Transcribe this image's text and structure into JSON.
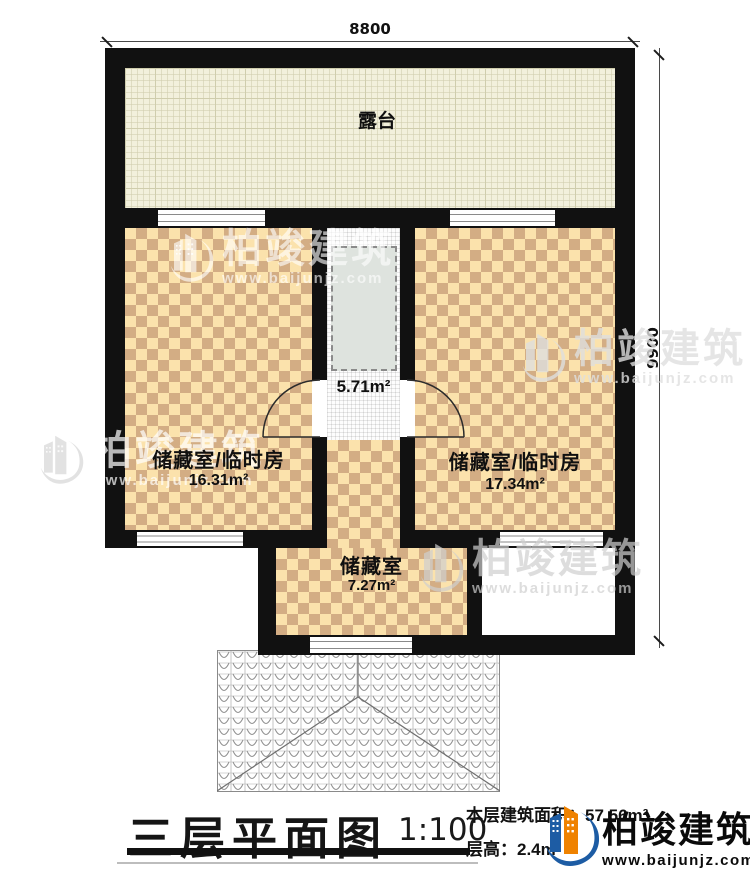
{
  "plan": {
    "dim_width": "8800",
    "dim_height": "9900",
    "rooms": {
      "terrace": {
        "name": "露台"
      },
      "left_storage": {
        "name": "储藏室/临时房",
        "area": "16.31m²"
      },
      "right_storage": {
        "name": "储藏室/临时房",
        "area": "17.34m²"
      },
      "stairwell": {
        "area": "5.71m²"
      },
      "bottom_storage": {
        "name": "储藏室",
        "area": "7.27m²"
      }
    }
  },
  "title_block": {
    "title": "三层平面图",
    "scale": "1:100",
    "area_line": "本层建筑面积：57.56m²",
    "height_line": "层高：2.4m"
  },
  "brand": {
    "name": "柏竣建筑",
    "url": "www.baijunjz.com"
  },
  "colors": {
    "wall": "#111111",
    "checker_light": "#fbe2ac",
    "checker_dark": "#d3ad84",
    "terrace_fill": "#f2f0dc",
    "stair_fill": "#dee3de",
    "brand_blue": "#1d5ca4",
    "brand_orange": "#ef8200"
  }
}
